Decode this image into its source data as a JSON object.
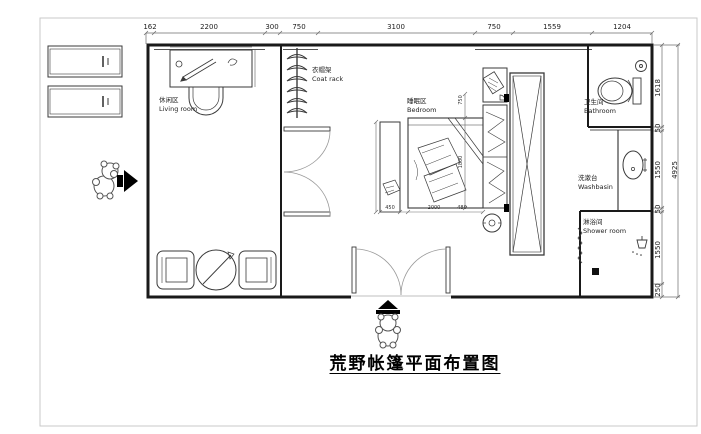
{
  "title": "荒野帐篷平面布置图",
  "labels": {
    "living": {
      "zh": "休闲区",
      "en": "Living room"
    },
    "coat_rack": {
      "zh": "衣帽架",
      "en": "Coat rack"
    },
    "bedroom": {
      "zh": "睡眠区",
      "en": "Bedroom"
    },
    "bathroom": {
      "zh": "卫生间",
      "en": "Bathroom"
    },
    "washbasin": {
      "zh": "洗漱台",
      "en": "Washbasin"
    },
    "shower": {
      "zh": "淋浴间",
      "en": "Shower room"
    }
  },
  "dims": {
    "top": [
      "162",
      "2200",
      "300",
      "750",
      "3100",
      "750",
      "1559",
      "1204"
    ],
    "right": [
      "1618",
      "50",
      "1550",
      "50",
      "1550",
      "250"
    ],
    "right_total": "4925",
    "interior": {
      "nightstand": "450",
      "bed_width": "2000",
      "gap": "480",
      "cabinet": "750",
      "bed_length": "1800"
    }
  },
  "colors": {
    "wall": "#1a1a1a",
    "furniture": "#3a3a3a",
    "dim_line": "#6b6b6b",
    "frame": "#c9c9c9",
    "background": "#ffffff"
  }
}
